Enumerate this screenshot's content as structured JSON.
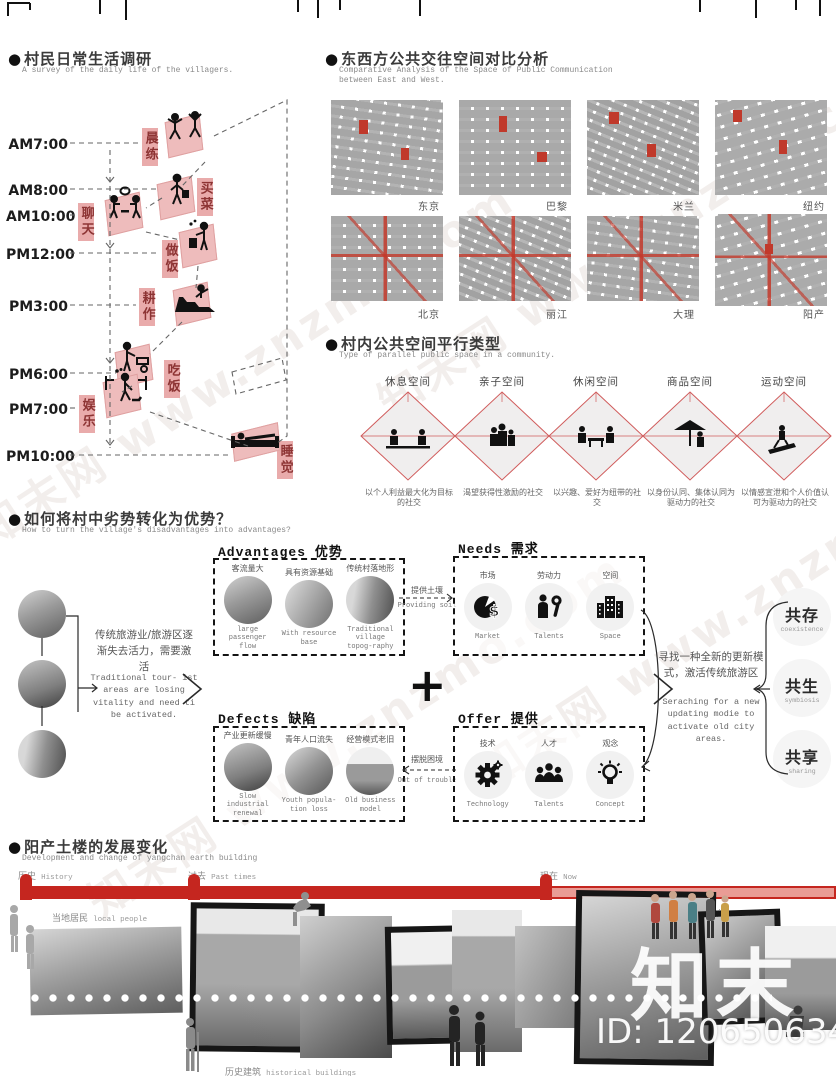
{
  "watermark": {
    "diagonal": "知末网 www.znzmo.com",
    "logo": "知末",
    "id": "ID: 1206506342"
  },
  "colors": {
    "accent_red": "#c0392b",
    "timeline_red": "#c5261f",
    "chip_pink": "#e9abab",
    "chip_text": "#8d3434",
    "tile_pink": "#eebcbc"
  },
  "daily_life": {
    "title": "村民日常生活调研",
    "subtitle": "A survey of the daily life of the villagers.",
    "entries": [
      {
        "time": "AM7:00",
        "activity": "晨练",
        "icon": "morning-exercise-icon"
      },
      {
        "time": "AM8:00",
        "activity": "买菜",
        "icon": "grocery-shopping-icon"
      },
      {
        "time": "AM10:00",
        "activity": "聊天",
        "icon": "chatting-icon"
      },
      {
        "time": "PM12:00",
        "activity": "做饭",
        "icon": "cooking-icon"
      },
      {
        "time": "PM3:00",
        "activity": "耕作",
        "icon": "farming-icon"
      },
      {
        "time": "PM6:00",
        "activity": "吃饭",
        "icon": "eating-icon"
      },
      {
        "time": "PM7:00",
        "activity": "娱乐",
        "icon": "entertainment-icon"
      },
      {
        "time": "PM10:00",
        "activity": "睡觉",
        "icon": "sleeping-icon"
      }
    ]
  },
  "comparison": {
    "title": "东西方公共交往空间对比分析",
    "subtitle": "Comparative Analysis of the Space of Public Communication between East and West.",
    "west_cities": [
      "东京",
      "巴黎",
      "米兰",
      "纽约"
    ],
    "east_cities": [
      "北京",
      "丽江",
      "大理",
      "阳产"
    ]
  },
  "parallel_space": {
    "title": "村内公共空间平行类型",
    "subtitle": "Type of parallel public space in a community.",
    "spaces": [
      {
        "name": "休息空间",
        "desc": "以个人利益最大化为目标的社交"
      },
      {
        "name": "亲子空间",
        "desc": "渴望获得性激励的社交"
      },
      {
        "name": "休闲空间",
        "desc": "以兴趣、爱好为纽带的社交"
      },
      {
        "name": "商品空间",
        "desc": "以身份认同、集体认同为驱动力的社交"
      },
      {
        "name": "运动空间",
        "desc": "以情感宣泄和个人价值认可为驱动力的社交"
      }
    ]
  },
  "transform": {
    "title": "如何将村中劣势转化为优势？",
    "subtitle": "How to turn the village's disadvantages into advantages?",
    "left_text_cn": "传统旅游业/旅游区逐渐失去活力，需要激活",
    "left_text_en": "Traditional tour- ist areas are losing vitality and need ti be activated.",
    "plus": "+",
    "advantages": {
      "header": "Advantages 优势",
      "items": [
        {
          "cn": "客流量大",
          "en": "large passenger flow"
        },
        {
          "cn": "具有资源基础",
          "en": "With resource base"
        },
        {
          "cn": "传统村落地形",
          "en": "Traditional village topog-raphy"
        }
      ]
    },
    "defects": {
      "header": "Defects 缺陷",
      "items": [
        {
          "cn": "产业更新缓慢",
          "en": "Slow industrial renewal"
        },
        {
          "cn": "青年人口流失",
          "en": "Youth popula-tion loss"
        },
        {
          "cn": "经营模式老旧",
          "en": "Old business model"
        }
      ]
    },
    "needs": {
      "header": "Needs 需求",
      "items": [
        {
          "cn": "市场",
          "en": "Market",
          "icon": "pie-dollar-icon"
        },
        {
          "cn": "劳动力",
          "en": "Talents",
          "icon": "worker-wrench-icon"
        },
        {
          "cn": "空间",
          "en": "Space",
          "icon": "buildings-icon"
        }
      ]
    },
    "offer": {
      "header": "Offer 提供",
      "items": [
        {
          "cn": "技术",
          "en": "Technology",
          "icon": "gear-icon"
        },
        {
          "cn": "人才",
          "en": "Talents",
          "icon": "people-icon"
        },
        {
          "cn": "观念",
          "en": "Concept",
          "icon": "lightbulb-icon"
        }
      ]
    },
    "arrow_soil_cn": "提供土壤",
    "arrow_soil_en": "Providing soil",
    "arrow_trouble_cn": "摆脱困境",
    "arrow_trouble_en": "Out of trouble",
    "right_text_cn": "寻找一种全新的更新模式，激活传统旅游区",
    "right_text_en": "Seraching for a new updating modie to activate old city areas.",
    "outcomes": [
      {
        "cn": "共存",
        "en": "coexistence"
      },
      {
        "cn": "共生",
        "en": "symbiosis"
      },
      {
        "cn": "共享",
        "en": "sharing"
      }
    ]
  },
  "development": {
    "title": "阳产土楼的发展变化",
    "subtitle": "Development and change of yangchan earth building",
    "milestones": [
      {
        "cn": "历史",
        "en": "History"
      },
      {
        "cn": "过去",
        "en": "Past times"
      },
      {
        "cn": "现在",
        "en": "Now"
      }
    ],
    "labels": {
      "local_people_cn": "当地居民",
      "local_people_en": "local people",
      "tourists_cn": "游客",
      "tourists_en": "tourists",
      "buildings_cn": "历史建筑",
      "buildings_en": "historical buildings"
    }
  }
}
